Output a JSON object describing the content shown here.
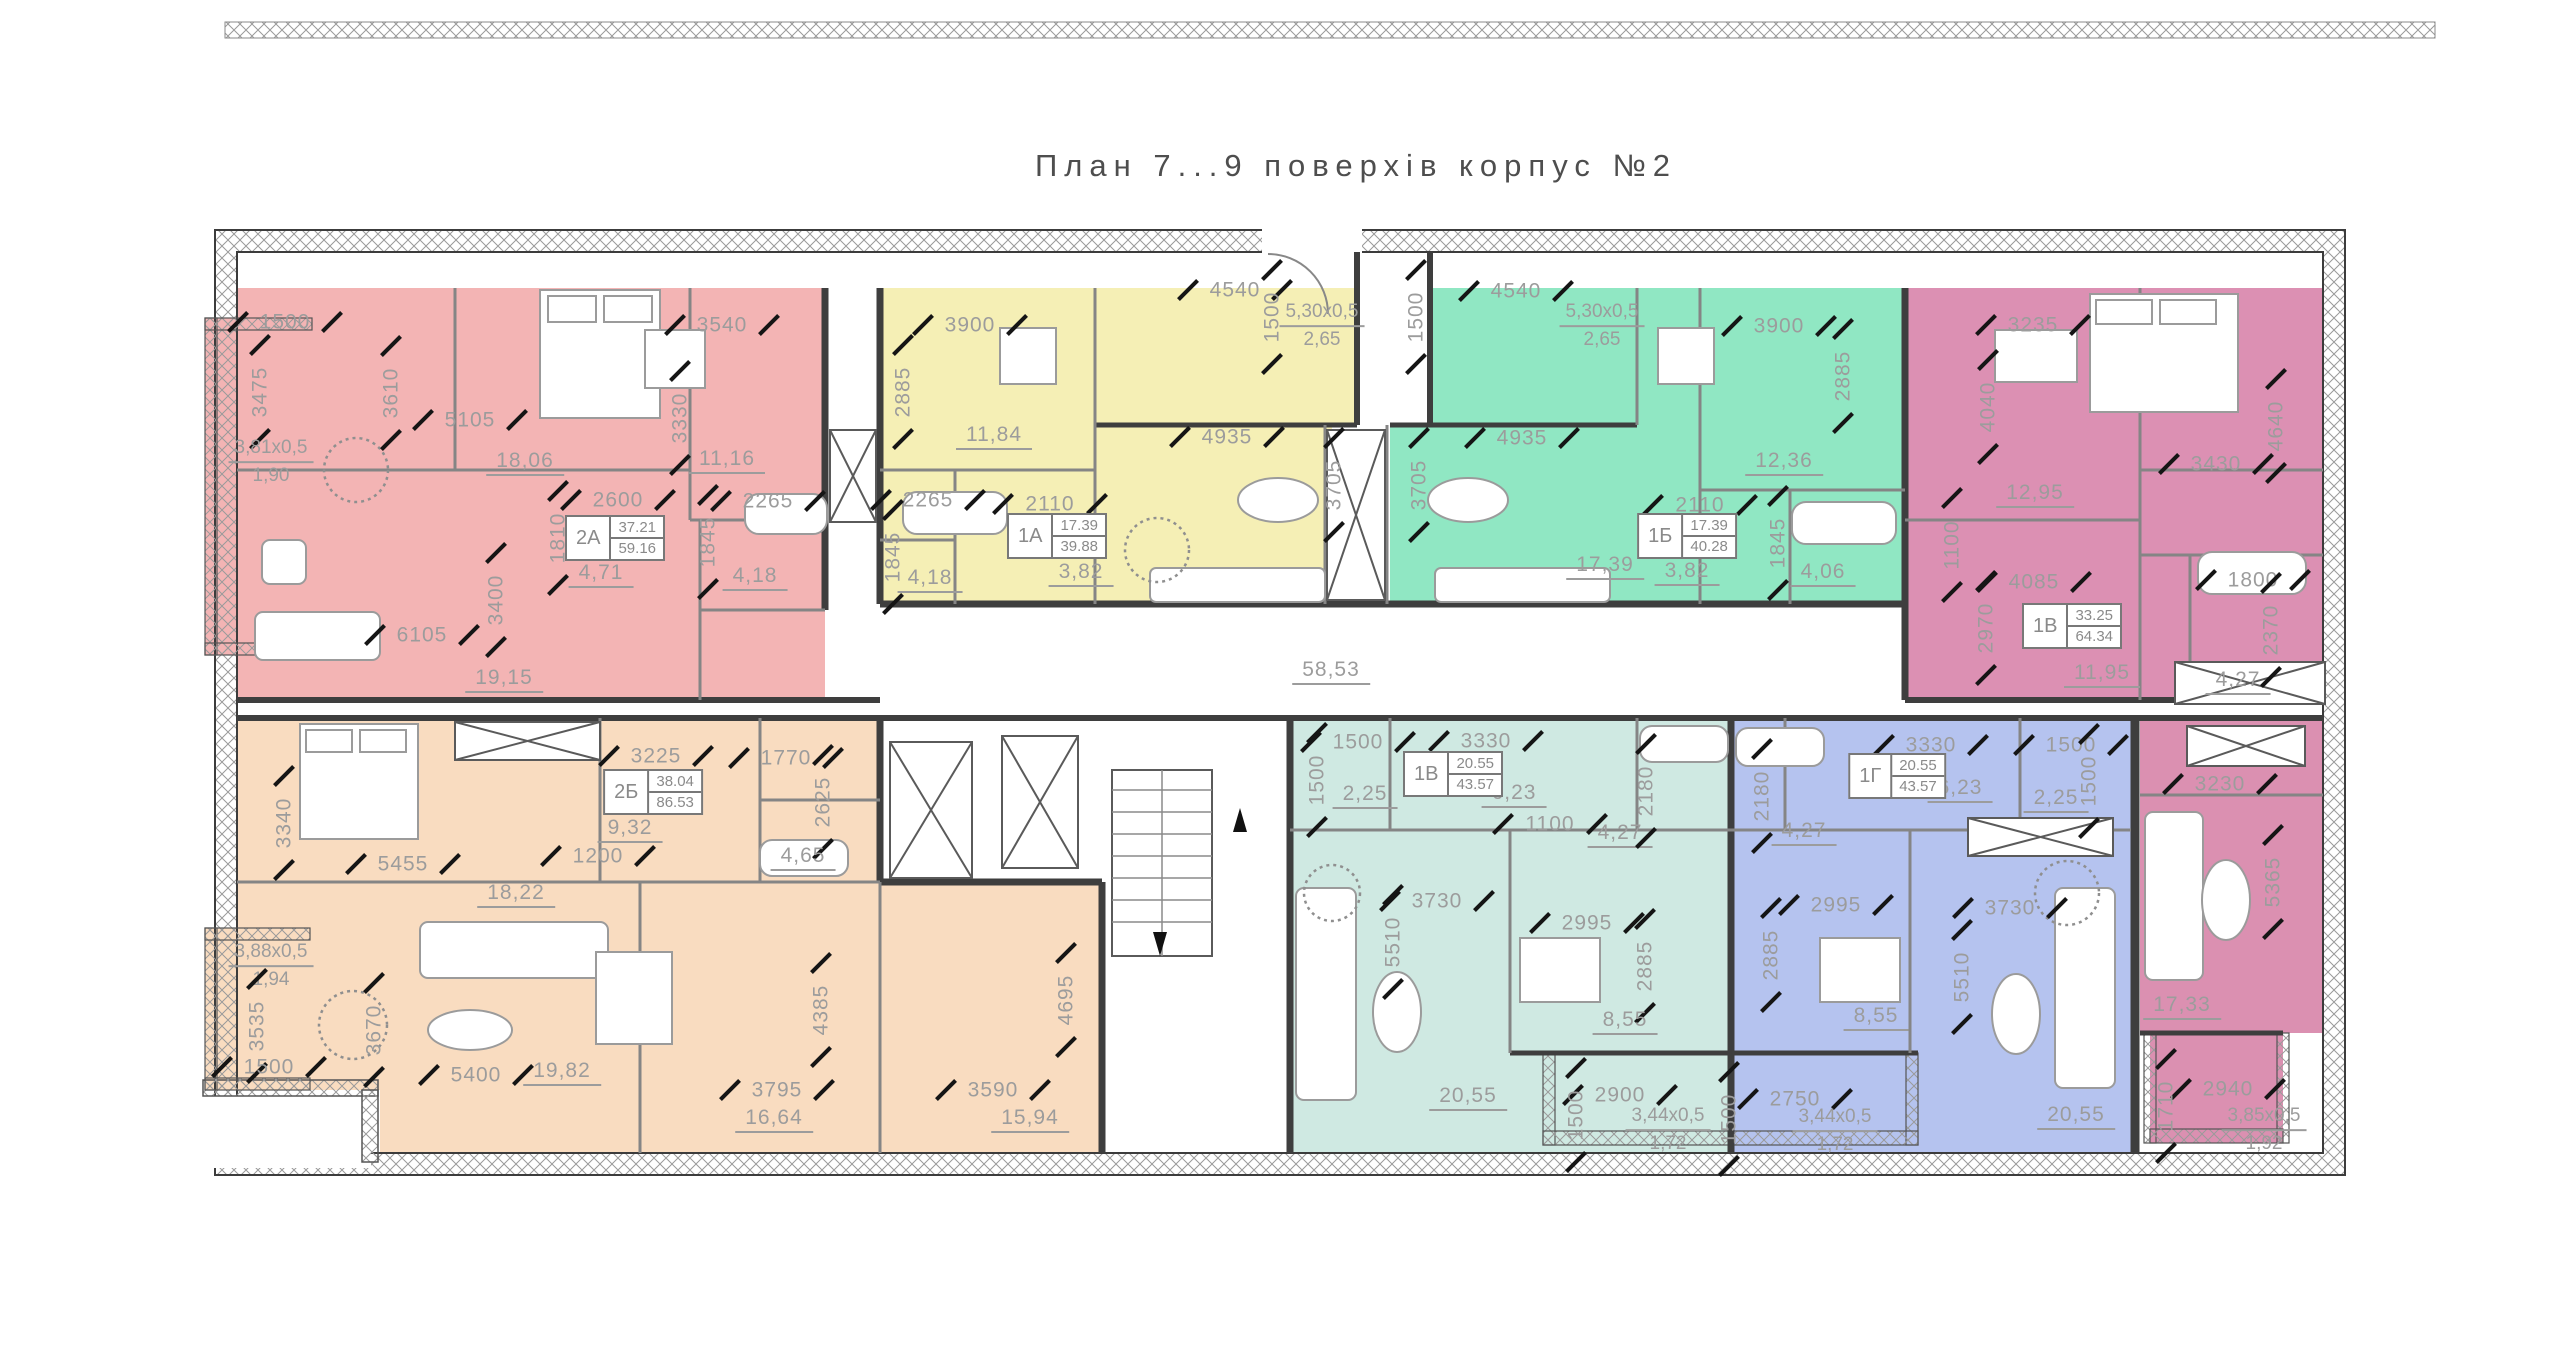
{
  "title": "План 7...9  поверхів  корпус  №2",
  "apartments": [
    {
      "id": "apt-2a",
      "code": "2А",
      "color": "#f3b4b4",
      "tag": {
        "code": "2А",
        "top": "37.21",
        "bottom": "59.16",
        "x": 615,
        "y": 538
      },
      "labels": [
        {
          "t": "1500",
          "x": 285,
          "y": 322
        },
        {
          "t": "3475",
          "x": 260,
          "y": 392,
          "v": true
        },
        {
          "t": "3,81х0,5",
          "b": "1,90",
          "x": 271,
          "y": 462
        },
        {
          "t": "3610",
          "x": 391,
          "y": 393,
          "v": true
        },
        {
          "t": "5105",
          "x": 470,
          "y": 420
        },
        {
          "t": "18,06",
          "x": 525,
          "y": 463,
          "u": true
        },
        {
          "t": "2600",
          "x": 618,
          "y": 500
        },
        {
          "t": "1810",
          "x": 558,
          "y": 538,
          "v": true
        },
        {
          "t": "4,71",
          "x": 601,
          "y": 575,
          "u": true
        },
        {
          "t": "3540",
          "x": 722,
          "y": 325
        },
        {
          "t": "3330",
          "x": 680,
          "y": 418,
          "v": true
        },
        {
          "t": "11,16",
          "x": 727,
          "y": 461,
          "u": true
        },
        {
          "t": "2265",
          "x": 768,
          "y": 501
        },
        {
          "t": "1845",
          "x": 708,
          "y": 542,
          "v": true
        },
        {
          "t": "4,18",
          "x": 755,
          "y": 578,
          "u": true
        },
        {
          "t": "6105",
          "x": 422,
          "y": 635
        },
        {
          "t": "3400",
          "x": 496,
          "y": 600,
          "v": true
        },
        {
          "t": "19,15",
          "x": 504,
          "y": 680,
          "u": true
        }
      ]
    },
    {
      "id": "apt-1a",
      "code": "1А",
      "color": "#f5efb5",
      "tag": {
        "code": "1А",
        "top": "17.39",
        "bottom": "39.88",
        "x": 1057,
        "y": 536
      },
      "labels": [
        {
          "t": "3900",
          "x": 970,
          "y": 325
        },
        {
          "t": "2885",
          "x": 903,
          "y": 392,
          "v": true
        },
        {
          "t": "11,84",
          "x": 994,
          "y": 437,
          "u": true
        },
        {
          "t": "2265",
          "x": 928,
          "y": 500
        },
        {
          "t": "1845",
          "x": 893,
          "y": 557,
          "v": true
        },
        {
          "t": "4,18",
          "x": 930,
          "y": 580,
          "u": true
        },
        {
          "t": "2110",
          "x": 1050,
          "y": 504
        },
        {
          "t": "3,82",
          "x": 1081,
          "y": 574,
          "u": true
        },
        {
          "t": "4540",
          "x": 1235,
          "y": 290
        },
        {
          "t": "1500",
          "x": 1272,
          "y": 317,
          "v": true
        },
        {
          "t": "5,30х0,5",
          "b": "2,65",
          "x": 1322,
          "y": 326
        },
        {
          "t": "4935",
          "x": 1227,
          "y": 437
        },
        {
          "t": "3705",
          "x": 1334,
          "y": 485,
          "v": true
        }
      ]
    },
    {
      "id": "apt-1b",
      "code": "1Б",
      "color": "#90e7c3",
      "tag": {
        "code": "1Б",
        "top": "17.39",
        "bottom": "40.28",
        "x": 1687,
        "y": 536
      },
      "labels": [
        {
          "t": "4540",
          "x": 1516,
          "y": 291
        },
        {
          "t": "1500",
          "x": 1416,
          "y": 317,
          "v": true
        },
        {
          "t": "5,30х0,5",
          "b": "2,65",
          "x": 1602,
          "y": 326
        },
        {
          "t": "3900",
          "x": 1779,
          "y": 326
        },
        {
          "t": "2885",
          "x": 1843,
          "y": 376,
          "v": true
        },
        {
          "t": "4935",
          "x": 1522,
          "y": 438
        },
        {
          "t": "3705",
          "x": 1419,
          "y": 485,
          "v": true
        },
        {
          "t": "12,36",
          "x": 1784,
          "y": 463,
          "u": true
        },
        {
          "t": "2110",
          "x": 1700,
          "y": 505
        },
        {
          "t": "17,39",
          "x": 1605,
          "y": 567,
          "u": true
        },
        {
          "t": "3,82",
          "x": 1687,
          "y": 573,
          "u": true
        },
        {
          "t": "1845",
          "x": 1778,
          "y": 543,
          "v": true
        },
        {
          "t": "4,06",
          "x": 1823,
          "y": 574,
          "u": true
        }
      ]
    },
    {
      "id": "apt-1v",
      "code": "1В",
      "color": "#dc90b3",
      "tag": {
        "code": "1В",
        "top": "33.25",
        "bottom": "64.34",
        "x": 2072,
        "y": 626
      },
      "labels": [
        {
          "t": "3235",
          "x": 2033,
          "y": 325
        },
        {
          "t": "4040",
          "x": 1988,
          "y": 407,
          "v": true
        },
        {
          "t": "12,95",
          "x": 2035,
          "y": 495,
          "u": true
        },
        {
          "t": "3430",
          "x": 2216,
          "y": 464
        },
        {
          "t": "4640",
          "x": 2276,
          "y": 426,
          "v": true
        },
        {
          "t": "1100",
          "x": 1952,
          "y": 545,
          "v": true
        },
        {
          "t": "4085",
          "x": 2034,
          "y": 582
        },
        {
          "t": "2970",
          "x": 1986,
          "y": 628,
          "v": true
        },
        {
          "t": "11,95",
          "x": 2102,
          "y": 675,
          "u": true
        },
        {
          "t": "1800",
          "x": 2253,
          "y": 580
        },
        {
          "t": "2370",
          "x": 2271,
          "y": 630,
          "v": true
        },
        {
          "t": "4,27",
          "x": 2238,
          "y": 682,
          "u": true
        }
      ]
    },
    {
      "id": "apt-1v2",
      "code": "1В",
      "color": "#db90b1",
      "labels": [
        {
          "t": "3230",
          "x": 2220,
          "y": 784
        },
        {
          "t": "5365",
          "x": 2273,
          "y": 882,
          "v": true
        },
        {
          "t": "17,33",
          "x": 2182,
          "y": 1007,
          "u": true
        },
        {
          "t": "2940",
          "x": 2228,
          "y": 1089
        },
        {
          "t": "1710",
          "x": 2166,
          "y": 1106,
          "v": true
        },
        {
          "t": "3,85х0,5",
          "b": "1,92",
          "x": 2264,
          "y": 1130
        }
      ]
    },
    {
      "id": "apt-2b",
      "code": "2Б",
      "color": "#f9dcc0",
      "tag": {
        "code": "2Б",
        "top": "38.04",
        "bottom": "86.53",
        "x": 653,
        "y": 792
      },
      "labels": [
        {
          "t": "3225",
          "x": 656,
          "y": 756
        },
        {
          "t": "1770",
          "x": 786,
          "y": 758
        },
        {
          "t": "9,32",
          "x": 630,
          "y": 830,
          "u": true
        },
        {
          "t": "2625",
          "x": 823,
          "y": 802,
          "v": true
        },
        {
          "t": "1200",
          "x": 598,
          "y": 856
        },
        {
          "t": "4,65",
          "x": 803,
          "y": 858,
          "u": true
        },
        {
          "t": "3340",
          "x": 284,
          "y": 823,
          "v": true
        },
        {
          "t": "5455",
          "x": 403,
          "y": 864
        },
        {
          "t": "18,22",
          "x": 516,
          "y": 895,
          "u": true
        },
        {
          "t": "3,88х0,5",
          "b": "1,94",
          "x": 271,
          "y": 966
        },
        {
          "t": "3535",
          "x": 257,
          "y": 1026,
          "v": true
        },
        {
          "t": "3670",
          "x": 374,
          "y": 1030,
          "v": true
        },
        {
          "t": "1500",
          "x": 269,
          "y": 1067
        },
        {
          "t": "5400",
          "x": 476,
          "y": 1075
        },
        {
          "t": "19,82",
          "x": 562,
          "y": 1073,
          "u": true
        },
        {
          "t": "3795",
          "x": 777,
          "y": 1090
        },
        {
          "t": "16,64",
          "x": 774,
          "y": 1120,
          "u": true
        },
        {
          "t": "4385",
          "x": 821,
          "y": 1010,
          "v": true
        },
        {
          "t": "3590",
          "x": 993,
          "y": 1090
        },
        {
          "t": "15,94",
          "x": 1030,
          "y": 1120,
          "u": true
        },
        {
          "t": "4695",
          "x": 1066,
          "y": 1000,
          "v": true
        }
      ]
    },
    {
      "id": "apt-1vc",
      "code": "1В",
      "color": "#cfe9e2",
      "tag": {
        "code": "1В",
        "top": "20.55",
        "bottom": "43.57",
        "x": 1453,
        "y": 774
      },
      "labels": [
        {
          "t": "1500",
          "x": 1358,
          "y": 742
        },
        {
          "t": "1500",
          "x": 1317,
          "y": 780,
          "v": true
        },
        {
          "t": "3330",
          "x": 1486,
          "y": 741
        },
        {
          "t": "2,25",
          "x": 1365,
          "y": 796,
          "u": true
        },
        {
          "t": "6,23",
          "x": 1514,
          "y": 795,
          "u": true
        },
        {
          "t": "1100",
          "x": 1550,
          "y": 824
        },
        {
          "t": "4,27",
          "x": 1620,
          "y": 835,
          "u": true
        },
        {
          "t": "2180",
          "x": 1646,
          "y": 791,
          "v": true
        },
        {
          "t": "3730",
          "x": 1437,
          "y": 901
        },
        {
          "t": "5510",
          "x": 1393,
          "y": 942,
          "v": true
        },
        {
          "t": "2995",
          "x": 1587,
          "y": 923
        },
        {
          "t": "2885",
          "x": 1645,
          "y": 966,
          "v": true
        },
        {
          "t": "8,55",
          "x": 1625,
          "y": 1022,
          "u": true
        },
        {
          "t": "20,55",
          "x": 1468,
          "y": 1098,
          "u": true
        },
        {
          "t": "2900",
          "x": 1620,
          "y": 1095
        },
        {
          "t": "1500",
          "x": 1576,
          "y": 1115,
          "v": true
        },
        {
          "t": "3,44х0,5",
          "b": "1,72",
          "x": 1668,
          "y": 1130
        }
      ]
    },
    {
      "id": "apt-1g",
      "code": "1Г",
      "color": "#b5c3ef",
      "tag": {
        "code": "1Г",
        "top": "20.55",
        "bottom": "43.57",
        "x": 1897,
        "y": 776
      },
      "labels": [
        {
          "t": "3330",
          "x": 1931,
          "y": 745
        },
        {
          "t": "1500",
          "x": 2071,
          "y": 745
        },
        {
          "t": "1500",
          "x": 2089,
          "y": 781,
          "v": true
        },
        {
          "t": "6,23",
          "x": 1960,
          "y": 790,
          "u": true
        },
        {
          "t": "2,25",
          "x": 2056,
          "y": 800,
          "u": true
        },
        {
          "t": "2180",
          "x": 1762,
          "y": 796,
          "v": true
        },
        {
          "t": "4,27",
          "x": 1804,
          "y": 833,
          "u": true
        },
        {
          "t": "2995",
          "x": 1836,
          "y": 905
        },
        {
          "t": "3730",
          "x": 2010,
          "y": 908
        },
        {
          "t": "2885",
          "x": 1771,
          "y": 955,
          "v": true
        },
        {
          "t": "8,55",
          "x": 1876,
          "y": 1018,
          "u": true
        },
        {
          "t": "5510",
          "x": 1962,
          "y": 977,
          "v": true
        },
        {
          "t": "2750",
          "x": 1795,
          "y": 1099
        },
        {
          "t": "1500",
          "x": 1729,
          "y": 1119,
          "v": true
        },
        {
          "t": "3,44х0,5",
          "b": "1,72",
          "x": 1835,
          "y": 1131
        },
        {
          "t": "20,55",
          "x": 2076,
          "y": 1117,
          "u": true
        }
      ]
    },
    {
      "id": "corridor",
      "code": "",
      "color": "",
      "labels": [
        {
          "t": "58,53",
          "x": 1331,
          "y": 672,
          "u": true
        }
      ]
    }
  ]
}
